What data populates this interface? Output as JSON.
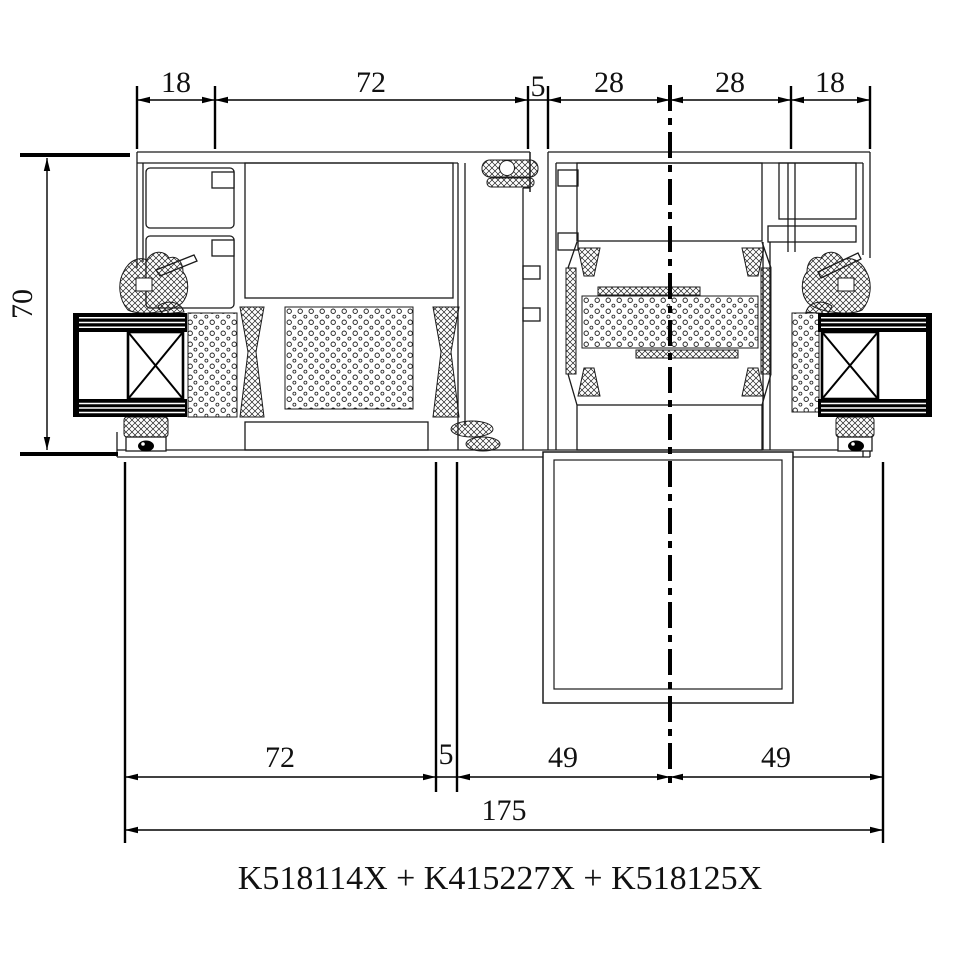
{
  "caption": {
    "text": "K518114X + K415227X + K518125X"
  },
  "dims": {
    "top": [
      "18",
      "72",
      "5",
      "28",
      "28",
      "18"
    ],
    "left": "70",
    "bottom": [
      "72",
      "5",
      "49",
      "49"
    ],
    "total": "175"
  },
  "colors": {
    "background": "#ffffff",
    "line": "#1b1b1b",
    "dimension_line": "#000000",
    "glass_fill": "#000000"
  },
  "drawing": {
    "type": "aluminium-profile-cross-section",
    "units": "mm"
  }
}
